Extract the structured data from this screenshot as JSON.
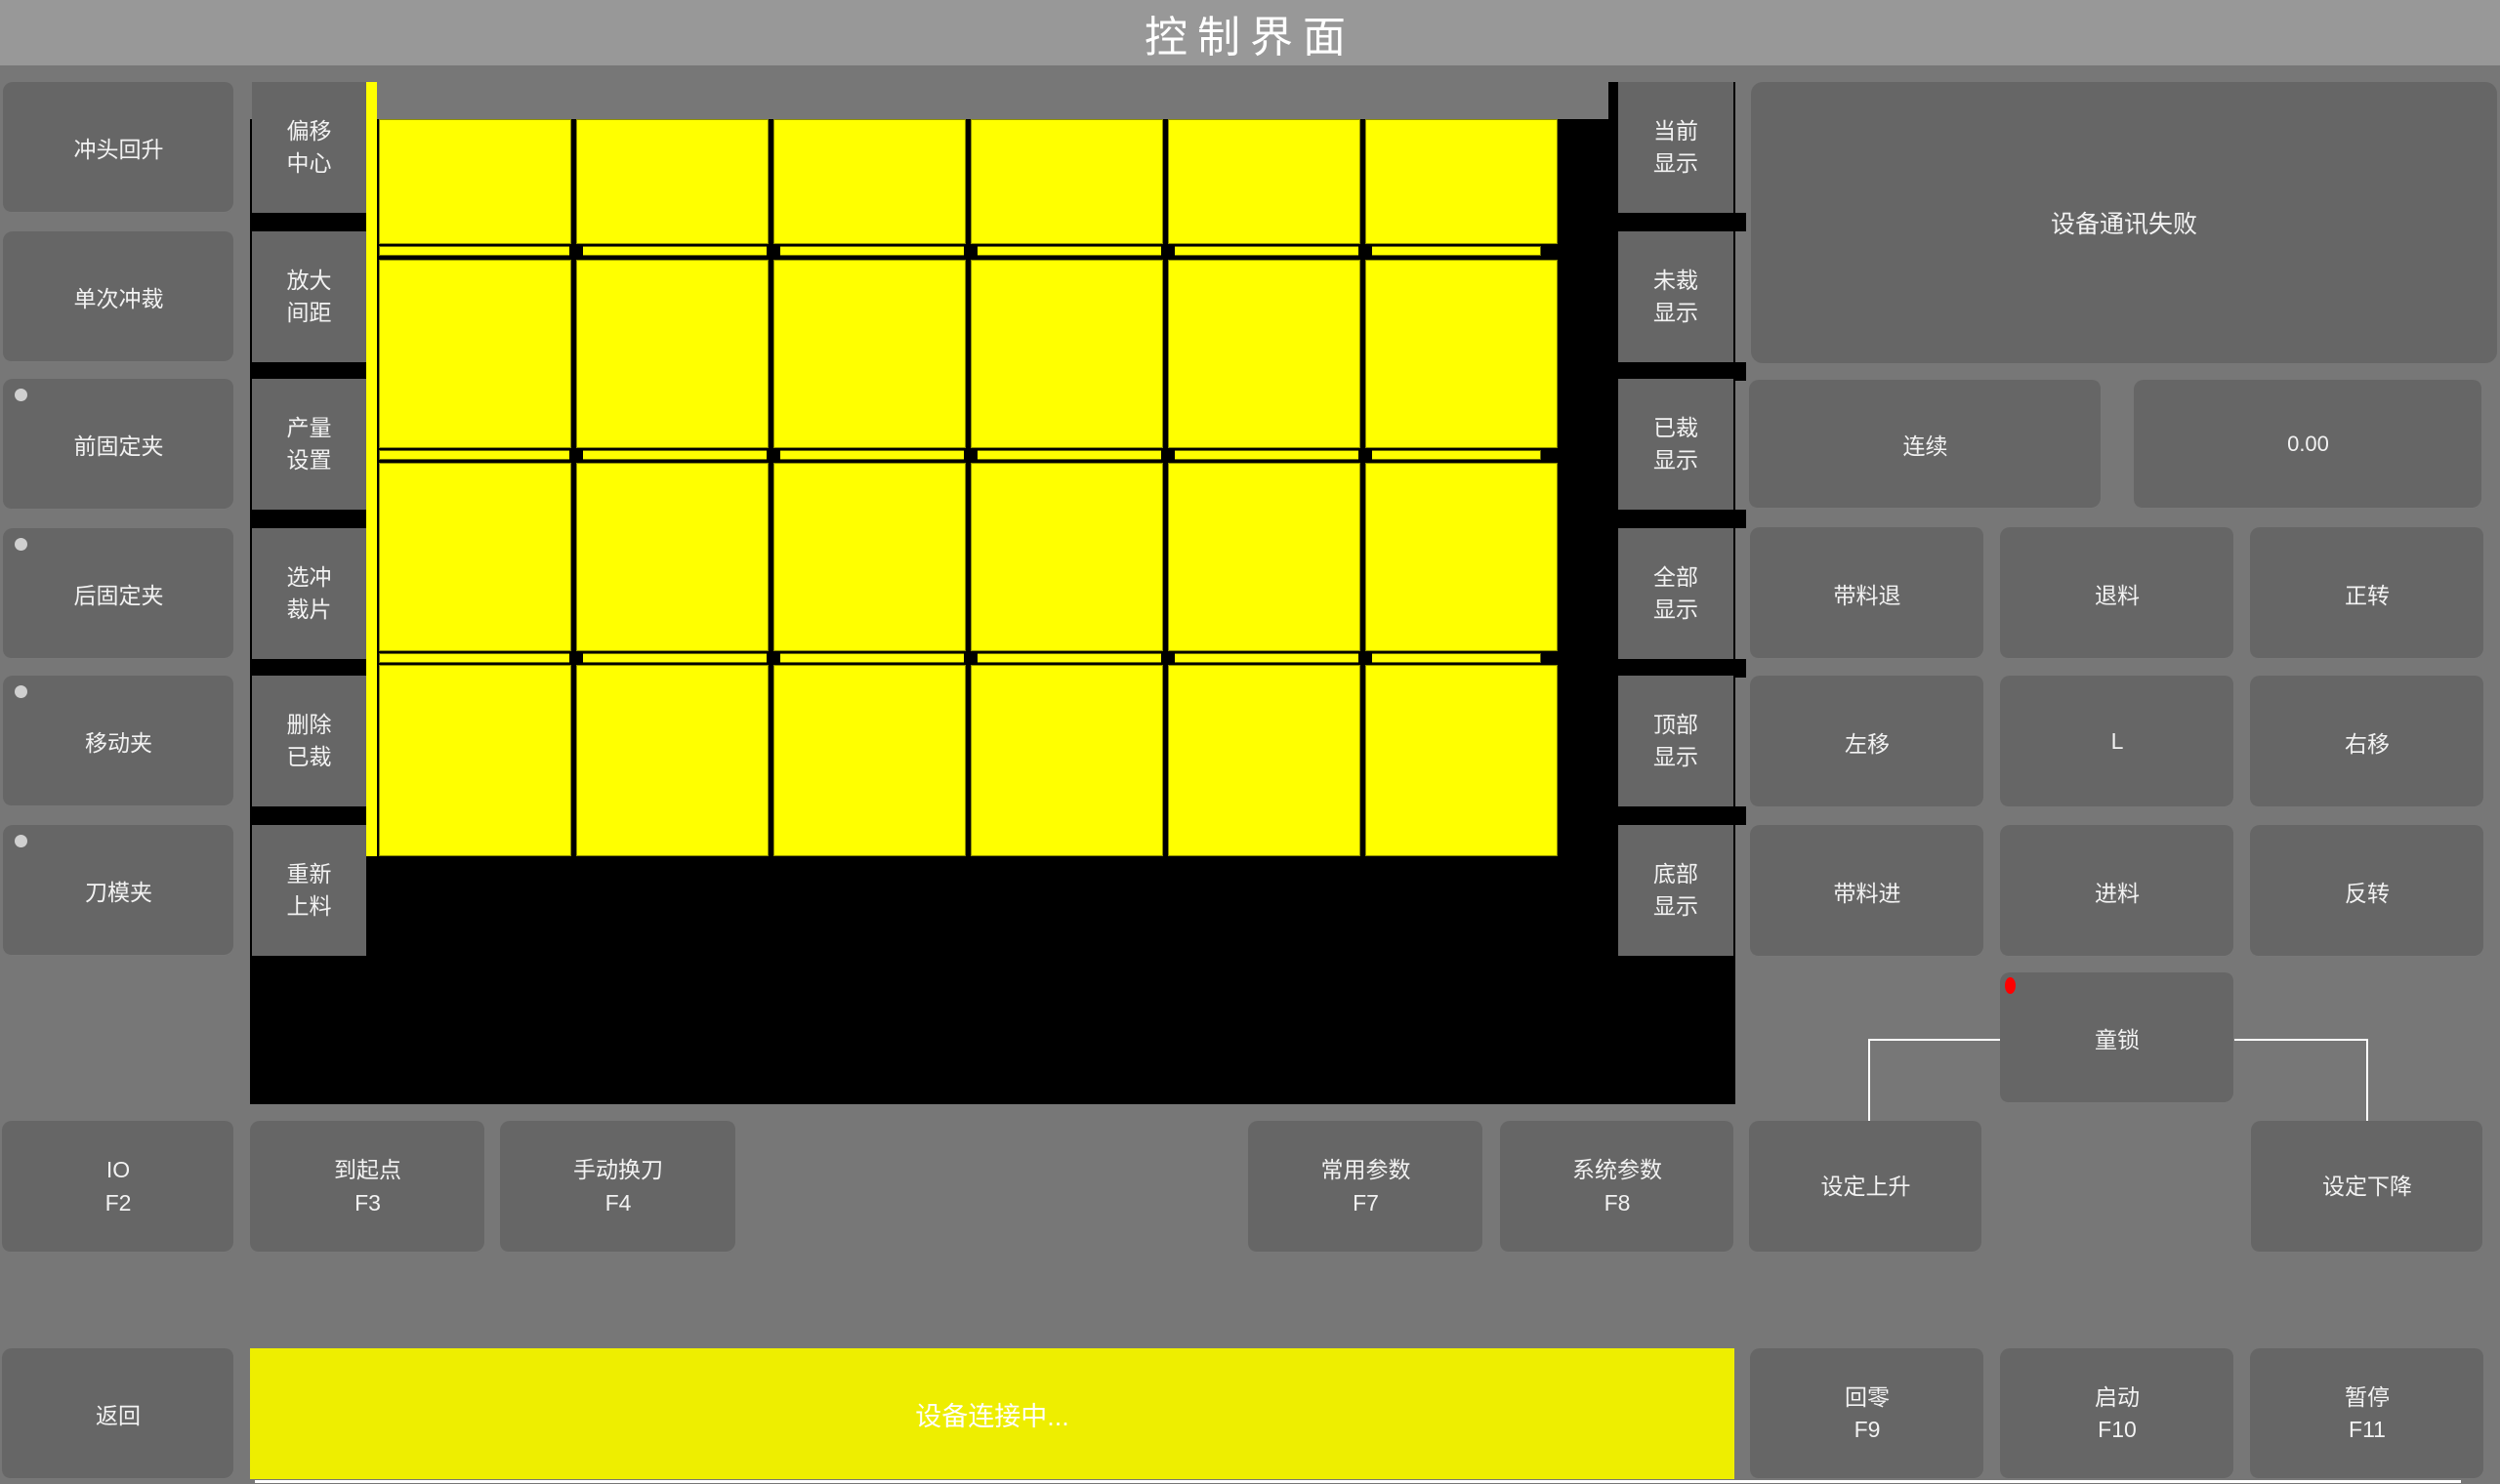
{
  "title": "控制界面",
  "colors": {
    "titlebar": "#989898",
    "background": "#777777",
    "button": "#666666",
    "canvas_black": "#000000",
    "sheet_yellow": "#ffff00",
    "bar_yellow": "#eeee00",
    "strip_border": "#6e6e00",
    "indicator_gray": "#d0d0d0",
    "alert_red": "#ff0000",
    "text": "#f2f2f2"
  },
  "left_panel": {
    "buttons": [
      {
        "name": "punch-return-up-button",
        "label": "冲头回升",
        "indicator": false
      },
      {
        "name": "single-punch-button",
        "label": "单次冲裁",
        "indicator": false
      },
      {
        "name": "front-fixed-clamp-button",
        "label": "前固定夹",
        "indicator": true
      },
      {
        "name": "rear-fixed-clamp-button",
        "label": "后固定夹",
        "indicator": true
      },
      {
        "name": "moving-clamp-button",
        "label": "移动夹",
        "indicator": true
      },
      {
        "name": "die-clamp-button",
        "label": "刀模夹",
        "indicator": true
      }
    ]
  },
  "canvas_panel": {
    "tool_buttons": [
      {
        "name": "offset-center-button",
        "lines": [
          "偏移",
          "中心"
        ]
      },
      {
        "name": "enlarge-spacing-button",
        "lines": [
          "放大",
          "间距"
        ]
      },
      {
        "name": "output-setting-button",
        "lines": [
          "产量",
          "设置"
        ]
      },
      {
        "name": "select-piece-button",
        "lines": [
          "选冲",
          "裁片"
        ]
      },
      {
        "name": "delete-cut-button",
        "lines": [
          "删除",
          "已裁"
        ]
      },
      {
        "name": "reload-material-button",
        "lines": [
          "重新",
          "上料"
        ]
      }
    ],
    "display_buttons": [
      {
        "name": "current-display-button",
        "lines": [
          "当前",
          "显示"
        ]
      },
      {
        "name": "uncut-display-button",
        "lines": [
          "未裁",
          "显示"
        ]
      },
      {
        "name": "cut-display-button",
        "lines": [
          "已裁",
          "显示"
        ]
      },
      {
        "name": "all-display-button",
        "lines": [
          "全部",
          "显示"
        ]
      },
      {
        "name": "top-display-button",
        "lines": [
          "顶部",
          "显示"
        ]
      },
      {
        "name": "bottom-display-button",
        "lines": [
          "底部",
          "显示"
        ]
      }
    ],
    "sheet": {
      "rows": 4,
      "cols": 6
    }
  },
  "right_panel": {
    "status_message": "设备通讯失败",
    "mode_button": "连续",
    "value_display": "0.00",
    "jog_rows": [
      [
        {
          "name": "belt-feed-back-button",
          "label": "带料退"
        },
        {
          "name": "unload-material-button",
          "label": "退料"
        },
        {
          "name": "forward-rotation-button",
          "label": "正转"
        }
      ],
      [
        {
          "name": "move-left-button",
          "label": "左移"
        },
        {
          "name": "l-button",
          "label": "L"
        },
        {
          "name": "move-right-button",
          "label": "右移"
        }
      ],
      [
        {
          "name": "belt-feed-forward-button",
          "label": "带料进"
        },
        {
          "name": "feed-material-button",
          "label": "进料"
        },
        {
          "name": "reverse-rotation-button",
          "label": "反转"
        }
      ]
    ],
    "child_lock": "童锁"
  },
  "function_keys": [
    {
      "name": "io-button",
      "label": "IO",
      "key": "F2"
    },
    {
      "name": "to-start-point-button",
      "label": "到起点",
      "key": "F3"
    },
    {
      "name": "manual-tool-change-button",
      "label": "手动换刀",
      "key": "F4"
    },
    {
      "name": "common-params-button",
      "label": "常用参数",
      "key": "F7"
    },
    {
      "name": "system-params-button",
      "label": "系统参数",
      "key": "F8"
    },
    {
      "name": "set-rise-button",
      "label": "设定上升",
      "key": ""
    },
    {
      "name": "set-fall-button",
      "label": "设定下降",
      "key": ""
    }
  ],
  "bottom_bar": {
    "back": "返回",
    "status": "设备连接中...",
    "keys": [
      {
        "name": "home-zero-button",
        "label": "回零",
        "key": "F9"
      },
      {
        "name": "start-button",
        "label": "启动",
        "key": "F10"
      },
      {
        "name": "pause-button",
        "label": "暂停",
        "key": "F11"
      }
    ]
  }
}
